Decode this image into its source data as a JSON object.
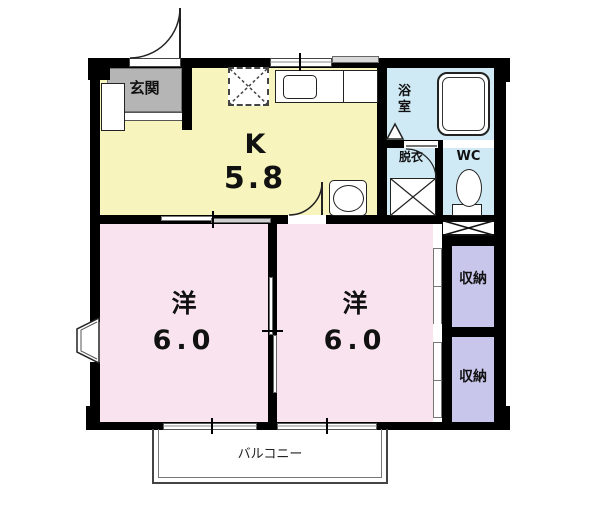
{
  "rooms": {
    "entrance": {
      "label": "玄関"
    },
    "kitchen": {
      "label": "K",
      "area": "5.8"
    },
    "bathroom": {
      "label": "浴室"
    },
    "dressing": {
      "label": "脱衣"
    },
    "wc": {
      "label": "WC"
    },
    "western_left": {
      "label": "洋",
      "area": "6.0"
    },
    "western_right": {
      "label": "洋",
      "area": "6.0"
    },
    "storage_top": {
      "label": "収納"
    },
    "storage_bottom": {
      "label": "収納"
    },
    "balcony": {
      "label": "バルコニー"
    }
  },
  "colors": {
    "kitchen_floor": "#f7f4bd",
    "western_floor": "#f8e3ee",
    "wet_area_floor": "#cfeaf5",
    "storage_floor": "#c9c6ec",
    "entrance_floor": "#b5b5b5",
    "wall": "#000000"
  }
}
